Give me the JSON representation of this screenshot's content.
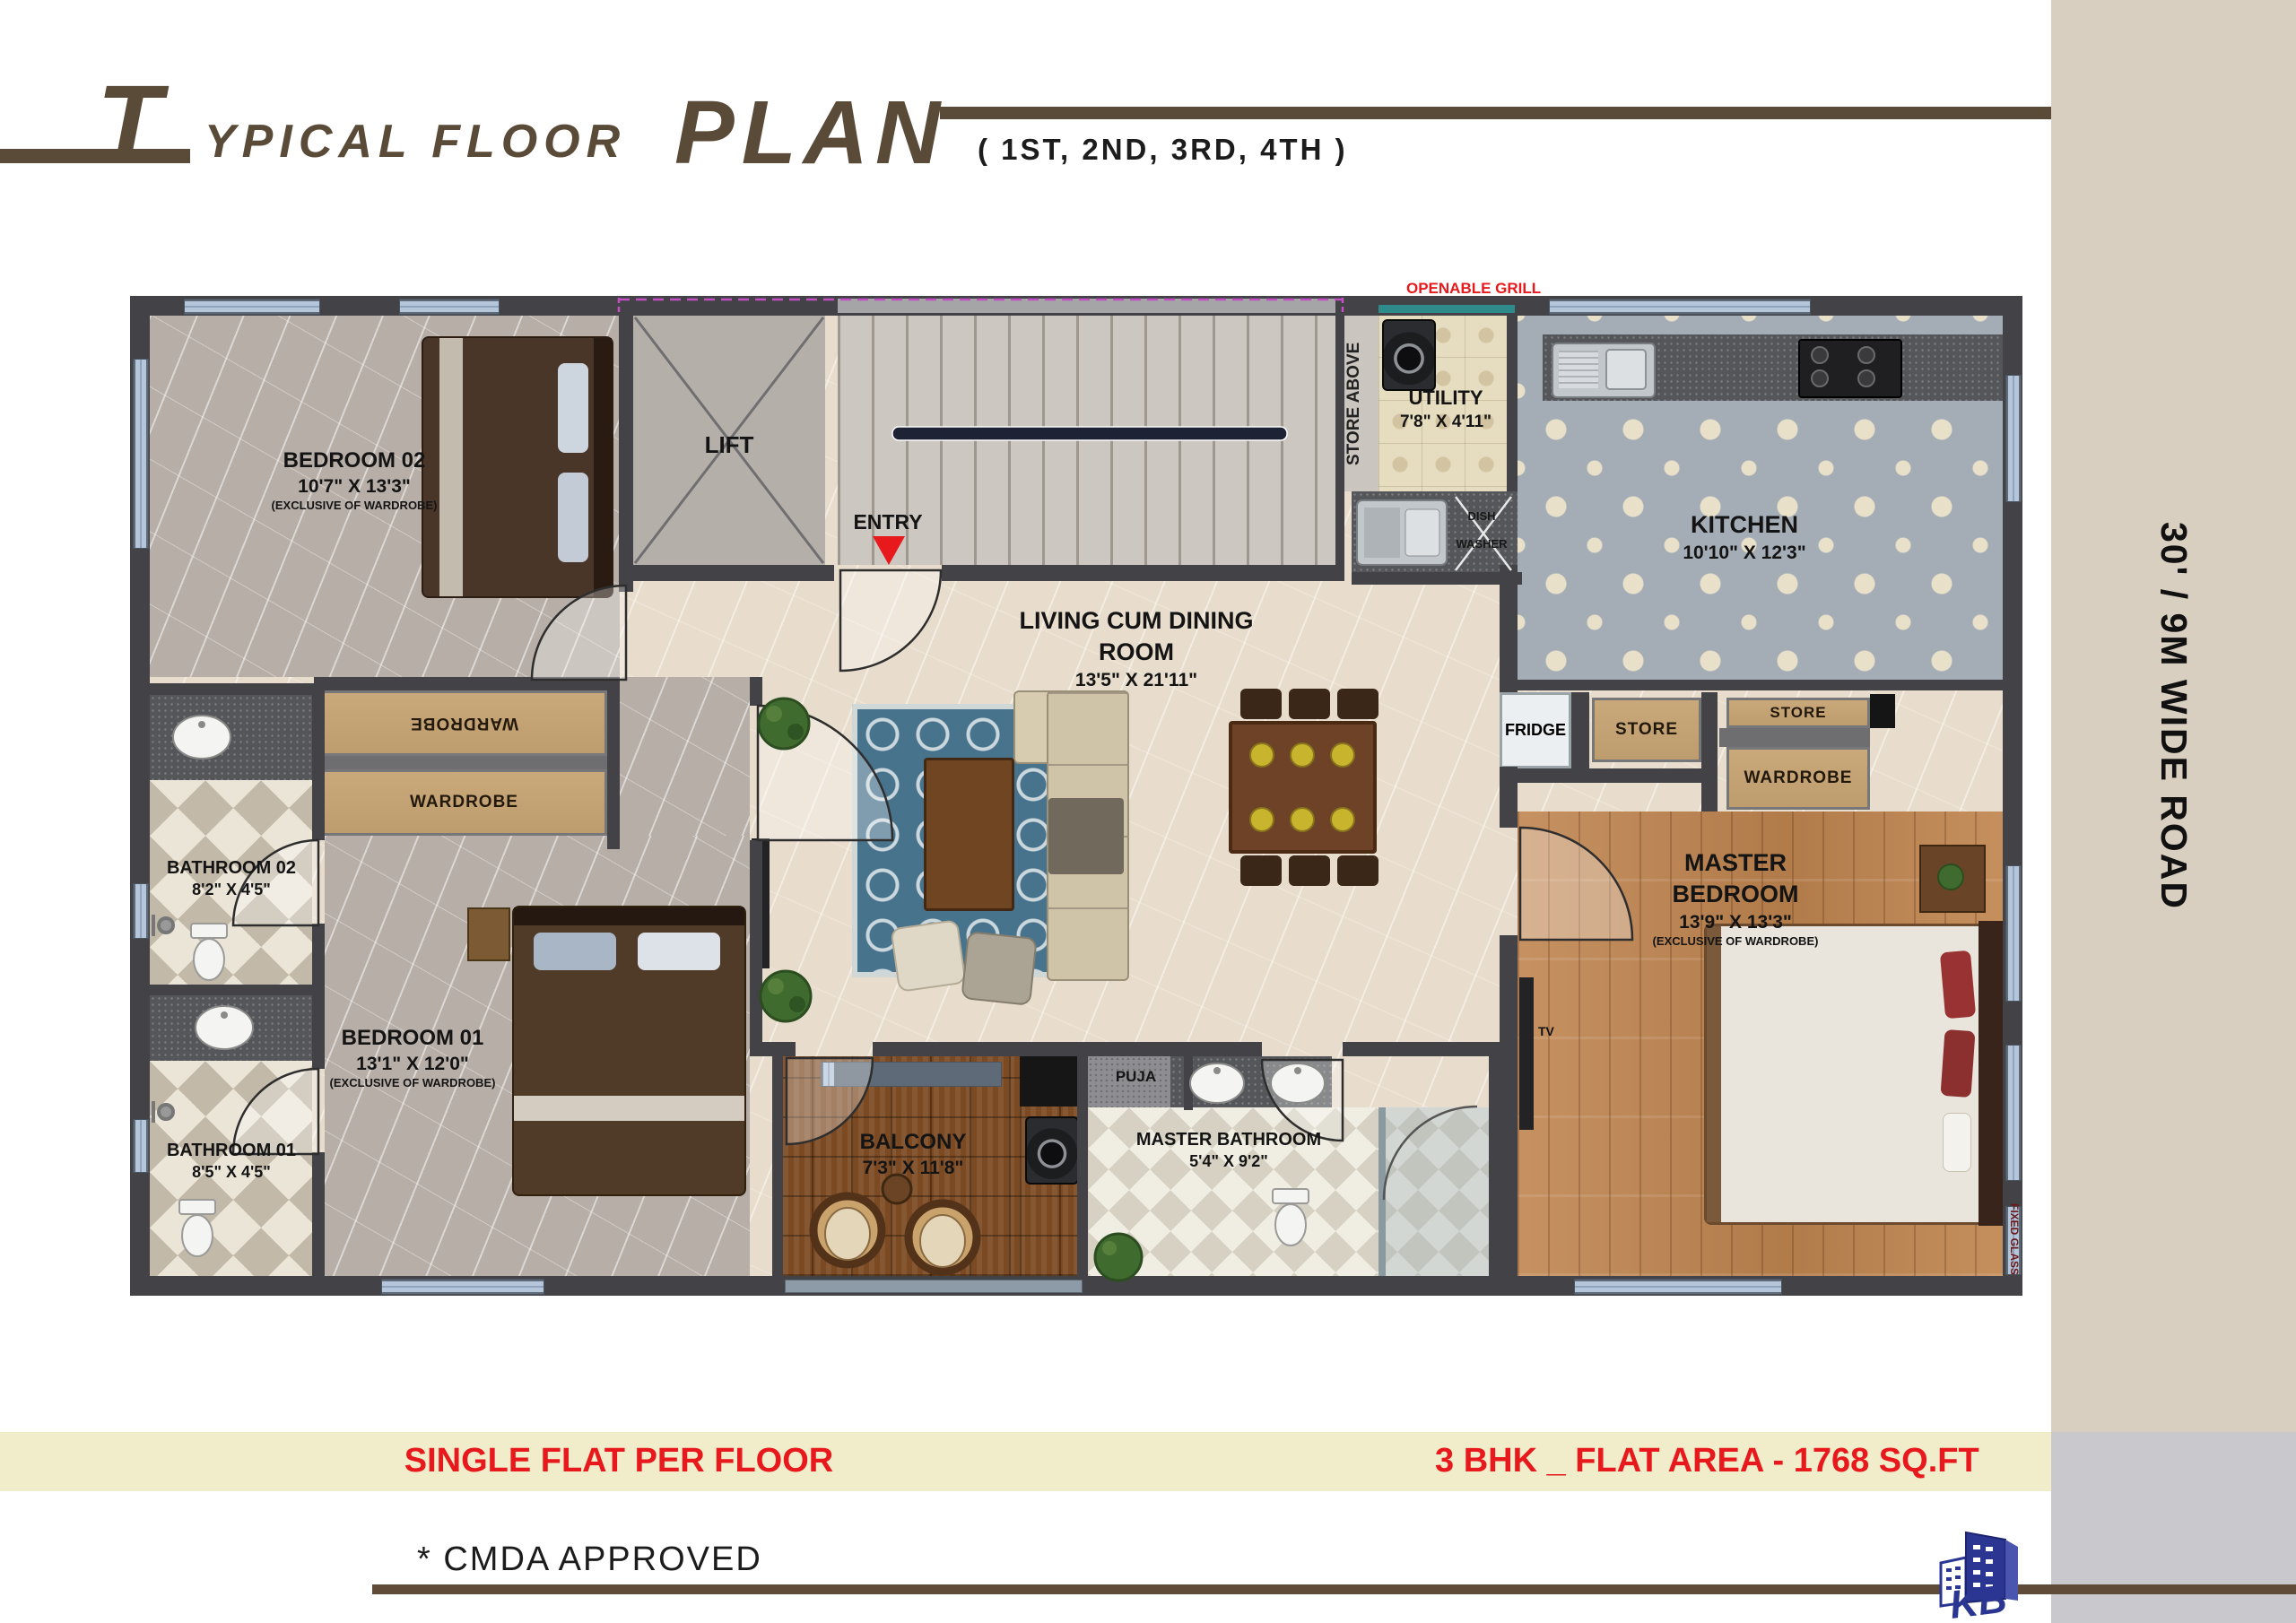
{
  "header": {
    "title_t": "T",
    "title_rest": "YPICAL FLOOR",
    "title_plan": "PLAN",
    "subtitle": "( 1ST, 2ND, 3RD, 4TH )"
  },
  "road": {
    "label": "30' / 9M WIDE ROAD"
  },
  "footer": {
    "flat_per_floor": "SINGLE FLAT PER FLOOR",
    "flat_area": "3 BHK _ FLAT AREA - 1768 SQ.FT",
    "approval": "* CMDA APPROVED",
    "logo_text": "KB"
  },
  "rooms": {
    "bedroom02": {
      "name": "BEDROOM 02",
      "dims": "10'7\" X 13'3\"",
      "note": "(EXCLUSIVE OF WARDROBE)"
    },
    "bedroom01": {
      "name": "BEDROOM 01",
      "dims": "13'1\" X 12'0\"",
      "note": "(EXCLUSIVE OF WARDROBE)"
    },
    "master_bedroom": {
      "name": "MASTER BEDROOM",
      "dims": "13'9\" X 13'3\"",
      "note": "(EXCLUSIVE OF WARDROBE)"
    },
    "living": {
      "name": "LIVING CUM DINING ROOM",
      "dims": "13'5\" X 21'11\""
    },
    "kitchen": {
      "name": "KITCHEN",
      "dims": "10'10\" X 12'3\""
    },
    "utility": {
      "name": "UTILITY",
      "dims": "7'8\" X 4'11\""
    },
    "balcony": {
      "name": "BALCONY",
      "dims": "7'3\" X 11'8\""
    },
    "bathroom02": {
      "name": "BATHROOM 02",
      "dims": "8'2\" X 4'5\""
    },
    "bathroom01": {
      "name": "BATHROOM 01",
      "dims": "8'5\" X 4'5\""
    },
    "master_bathroom": {
      "name": "MASTER BATHROOM",
      "dims": "5'4\" X 9'2\""
    },
    "lift": {
      "name": "LIFT"
    },
    "entry": {
      "name": "ENTRY"
    },
    "puja": {
      "name": "PUJA"
    }
  },
  "annotations": {
    "openable_grill": "OPENABLE GRILL",
    "store_above": "STORE ABOVE",
    "dish_washer": "DISH WASHER",
    "fridge": "FRIDGE",
    "store_a": "STORE",
    "store_b": "STORE",
    "wardrobe_master": "WARDROBE",
    "wardrobe_b2_top": "WARDROBE",
    "wardrobe_b2_bottom": "WARDROBE",
    "tv": "TV",
    "fixed_glass": "FIXED GLASS"
  },
  "colors": {
    "brand_brown": "#5a4a38",
    "accent_red": "#e8191c",
    "bar_yellow": "#f1ecca",
    "road_beige": "#d8cfc0",
    "logo_blue": "#2b3693"
  }
}
